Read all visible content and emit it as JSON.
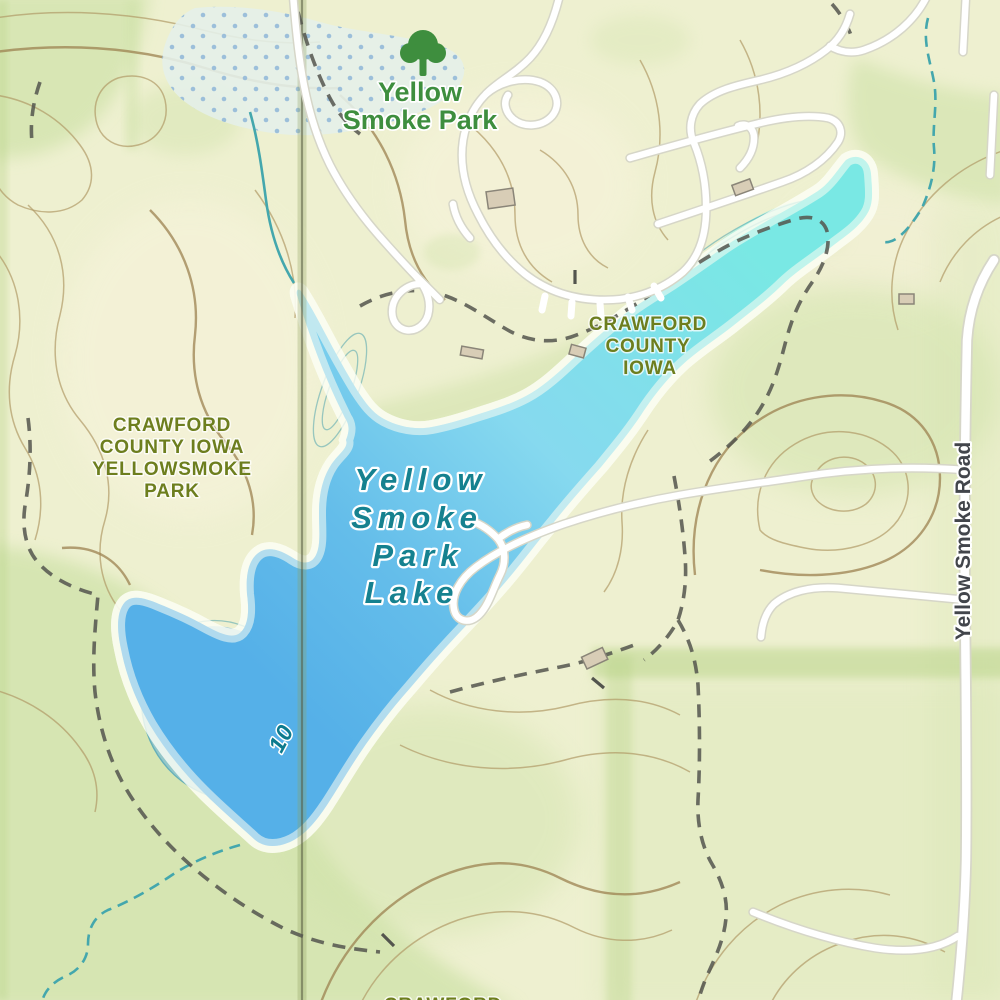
{
  "map": {
    "region": "Yellow Smoke Park, Crawford County, Iowa",
    "labels": {
      "park": {
        "lines": [
          "Yellow",
          "Smoke Park"
        ],
        "color": "#3e8e3e"
      },
      "county_ne": {
        "lines": [
          "CRAWFORD",
          "COUNTY",
          "IOWA"
        ],
        "color": "#6d7e1e"
      },
      "county_west": {
        "lines": [
          "CRAWFORD",
          "COUNTY IOWA",
          "YELLOWSMOKE",
          "PARK"
        ],
        "color": "#6d7e1e"
      },
      "lake": {
        "lines": [
          "Yellow",
          "Smoke",
          "Park",
          "Lake"
        ],
        "color": "#15818f"
      },
      "road": {
        "text": "Yellow Smoke Road",
        "color": "#42454b"
      },
      "depth_contour": {
        "text": "10",
        "color": "#0c7a8e"
      },
      "county_south_partial": {
        "text": "CRAWFORD",
        "color": "#6d7e1e"
      }
    },
    "icons": {
      "tree": {
        "name": "tree-icon",
        "color": "#3e8e3e"
      }
    },
    "colors": {
      "land": "#eef0d0",
      "woodland": "#cfe2a9",
      "contour": "#b09a66",
      "contour_index": "#9c8150",
      "lake_shallow": "#79e8e4",
      "lake_mid": "#86d9ef",
      "lake_deep": "#55b0e8",
      "lake_outline": "#2a93a8",
      "bathymetry_contour": "#2c93a6",
      "road_fill": "#ffffff",
      "road_casing": "#d6d6c8",
      "trail": "#53554e",
      "stream": "#44a7ad",
      "marsh_dot": "#8fb6d8",
      "building_fill": "#d8cdb6",
      "building_stroke": "#8a8578"
    }
  }
}
